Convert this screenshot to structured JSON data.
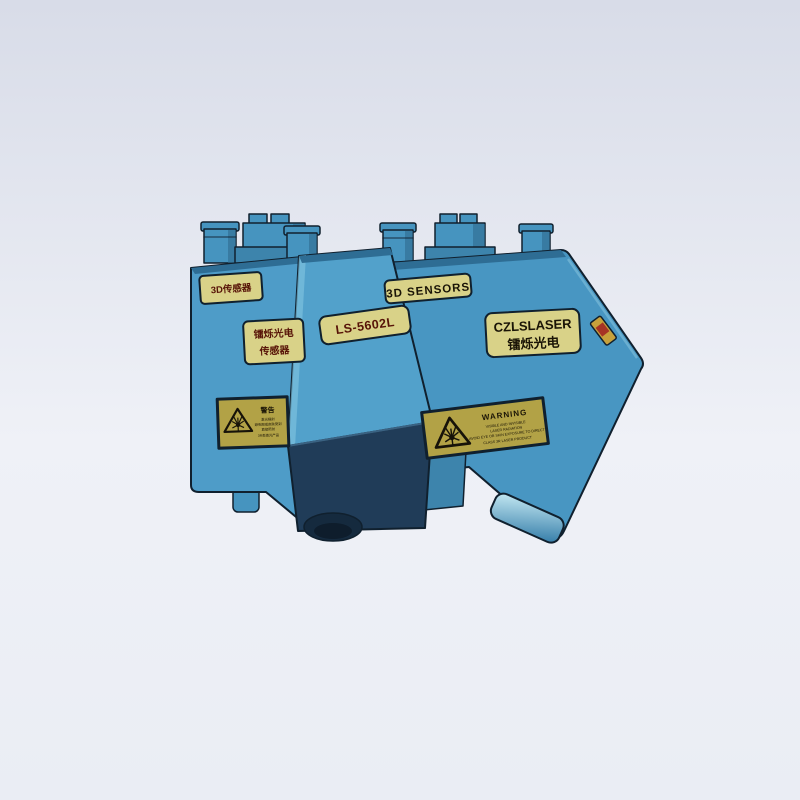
{
  "scene": {
    "device_labels": {
      "left_top_label": "3D传感器",
      "left_side_label_line1": "镭烁光电",
      "left_side_label_line2": "传感器",
      "model_label": "LS-5602L",
      "sensors_label": "3D SENSORS",
      "brand_label_en": "CZLSLASER",
      "brand_label_cn": "镭烁光电"
    },
    "warning_left": {
      "title": "警告",
      "line1": "激光辐射",
      "line2": "避免眼或皮肤受到",
      "line3": "直接照射",
      "line4": "3R类激光产品"
    },
    "warning_right": {
      "title": "WARNING",
      "line1": "VISIBLE AND INVISIBLE",
      "line2": "LASER RADIATION",
      "line3": "AVOID EYE OR SKIN EXPOSURE TO DIRECT",
      "line4": "CLASS 3R LASER PRODUCT"
    }
  },
  "colors": {
    "background_top": "#D8DCE8",
    "background_mid": "#EFF1F7",
    "background_bottom": "#EAEDF4",
    "body_blue_left": "#4E9CC8",
    "body_blue_right": "#4896C2",
    "body_blue_slab": "#52A1CB",
    "body_blue_mid": "#3D84AC",
    "top_bevel": "#2E6D94",
    "panel_dark": "#203C58",
    "lens_dark": "#152A3E",
    "cylinder_blue": "#4694BF",
    "cylinder_shade": "#2E6B90",
    "outline": "#10202E",
    "label_bg": "#D9D288",
    "warning_bg": "#B2A246",
    "text_dark": "#1A1406",
    "text_red": "#571307",
    "foot_light": "#C9ECF5",
    "foot_blue": "#2F79A6",
    "pin_gold": "#C7A13B",
    "pin_red": "#A63325"
  }
}
